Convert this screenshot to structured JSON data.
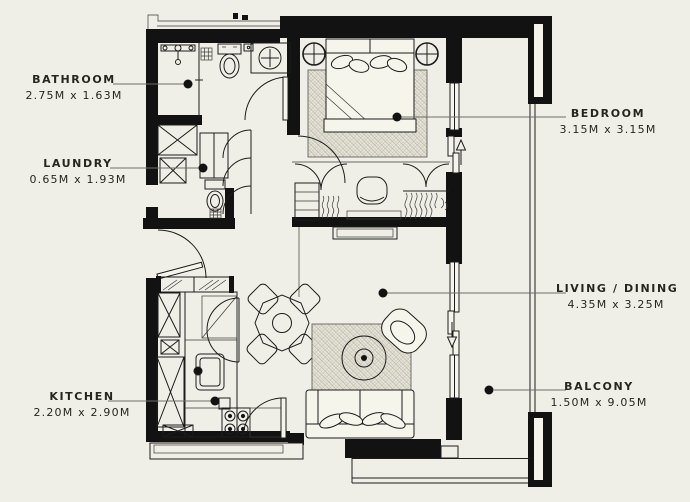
{
  "title": "Apartment floor plan",
  "colors": {
    "background": "#f0efe7",
    "walls": "#121212",
    "lines": "#1c1c1c",
    "leader_line": "#6e6e68",
    "text": "#26261f",
    "rug_hatch": "#a19e90"
  },
  "rooms": [
    {
      "id": "bathroom",
      "name": "BATHROOM",
      "dims": "2.75M x 1.63M"
    },
    {
      "id": "laundry",
      "name": "LAUNDRY",
      "dims": "0.65M x 1.93M"
    },
    {
      "id": "kitchen",
      "name": "KITCHEN",
      "dims": "2.20M x 2.90M"
    },
    {
      "id": "bedroom",
      "name": "BEDROOM",
      "dims": "3.15M x 3.15M"
    },
    {
      "id": "living_dining",
      "name": "LIVING / DINING",
      "dims": "4.35M x 3.25M"
    },
    {
      "id": "balcony",
      "name": "BALCONY",
      "dims": "1.50M x 9.05M"
    }
  ]
}
